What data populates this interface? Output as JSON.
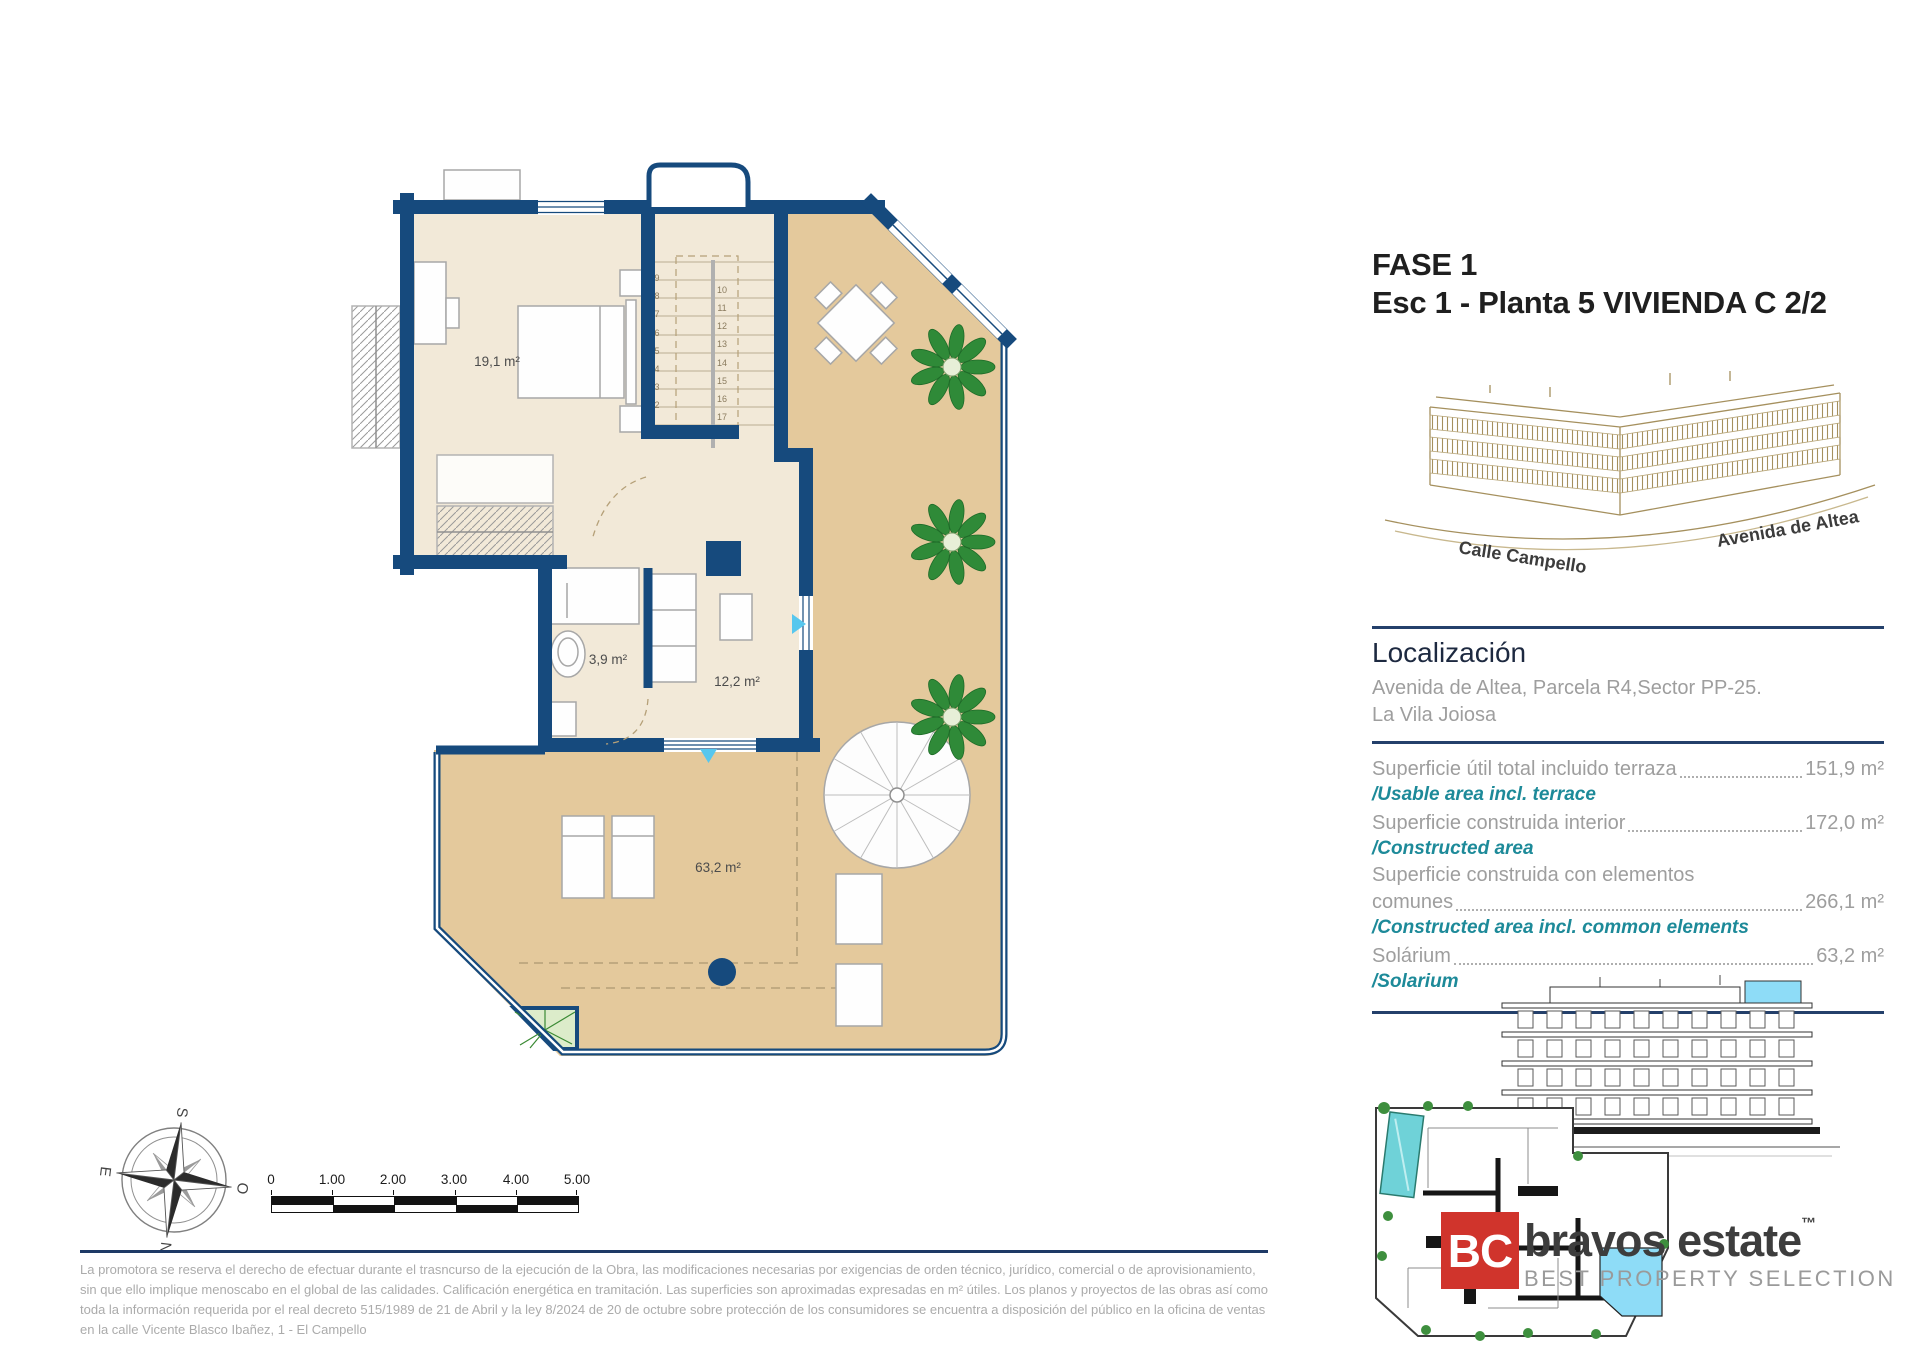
{
  "title": {
    "line1": "FASE 1",
    "line2": "Esc 1 - Planta 5 VIVIENDA C  2/2"
  },
  "sketch": {
    "street_left": "Calle Campello",
    "street_right": "Avenida de Altea"
  },
  "localization": {
    "heading": "Localización",
    "address": "Avenida de Altea, Parcela R4,Sector PP-25.",
    "city": "La Vila Joiosa"
  },
  "areas": {
    "rows": [
      {
        "es": "Superficie útil total incluido terraza",
        "value": "151,9 m²",
        "en": "/Usable area incl. terrace"
      },
      {
        "es": "Superficie construida interior",
        "value": "172,0 m²",
        "en": "/Constructed area"
      },
      {
        "es_line1": "Superficie construida con elementos",
        "es": "comunes",
        "value": "266,1 m²",
        "en": "/Constructed area incl. common elements"
      },
      {
        "es": "Solárium",
        "value": "63,2 m²",
        "en": "/Solarium"
      }
    ]
  },
  "plan": {
    "room_labels": {
      "bedroom": "19,1 m²",
      "bathroom": "3,9 m²",
      "living": "12,2 m²",
      "solarium": "63,2 m²"
    },
    "stairs_left": [
      "9",
      "8",
      "7",
      "6",
      "5",
      "4",
      "3",
      "2"
    ],
    "stairs_right": [
      "10",
      "11",
      "12",
      "13",
      "14",
      "15",
      "16",
      "17",
      "18"
    ]
  },
  "compass": {
    "top": "O",
    "right": "N",
    "bottom": "E",
    "left": "S"
  },
  "scalebar": {
    "labels": [
      "0",
      "1.00",
      "2.00",
      "3.00",
      "4.00",
      "5.00"
    ]
  },
  "legal": {
    "disclaimer": "La promotora se reserva el derecho de efectuar durante el trasncurso de la ejecución de la Obra, las modificaciones necesarias por exigencias de orden técnico, jurídico, comercial o de aprovisionamiento, sin que ello implique menoscabo en el global de las calidades. Calificación energética en tramitación. Las superficies son aproximadas expresadas en m² útiles. Los planos y proyectos de las obras así como toda la información requerida por el real decreto 515/1989 de 21 de Abril y la ley 8/2024 de 20 de octubre sobre protección de los consumidores se encuentra a disposición del público en la oficina de ventas en la calle Vicente Blasco Ibañez, 1 - El Campello"
  },
  "logo": {
    "initials": "BC",
    "name": "bravos estate",
    "tm": "™",
    "tagline": "BEST PROPERTY SELECTION"
  },
  "colors": {
    "wall_navy": "#164a7d",
    "interior_cream": "#f2e9d8",
    "terrace_tan": "#e4c99c",
    "teal": "#1d8a99",
    "divider_navy": "#1f3c6d",
    "logo_red": "#d0342c",
    "highlight_cyan": "#8edcf7",
    "plant_green": "#2f8a38",
    "text_gray": "#9e9e9e"
  }
}
